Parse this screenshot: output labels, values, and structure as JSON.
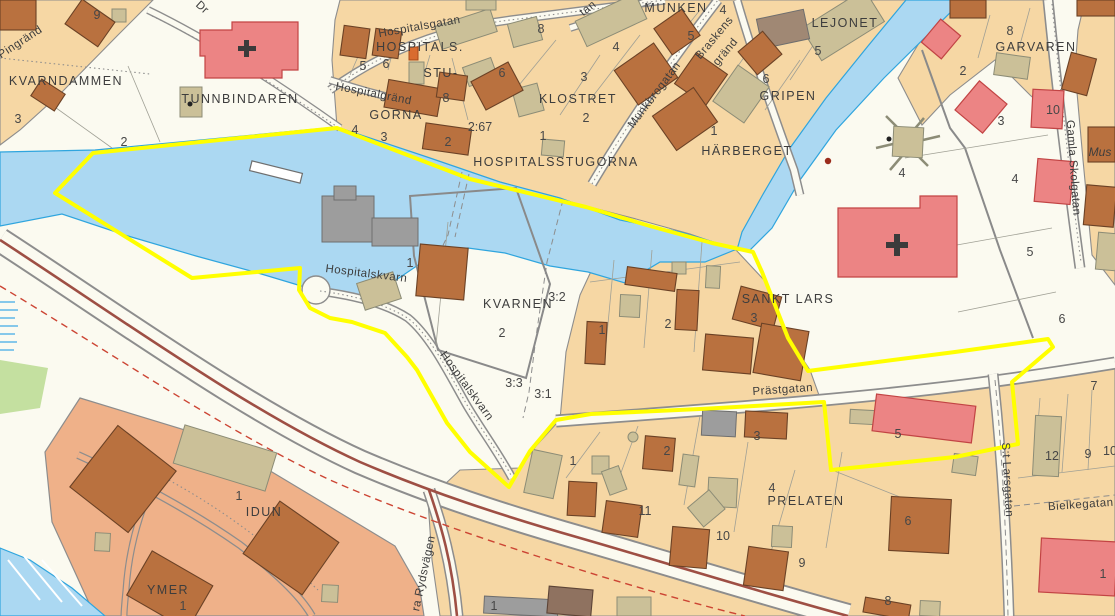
{
  "map": {
    "type": "cadastral-city-map",
    "colors": {
      "bg": "#FBFAF0",
      "block_tan": "#F6D7A4",
      "block_salmon": "#EFB189",
      "water": "#ABD8F2",
      "water_edge": "#2FA5DE",
      "green": "#C4E0A0",
      "building_brown": "#B9713F",
      "building_red": "#EC8484",
      "building_khaki": "#CBC098",
      "building_gray": "#9D9D9D",
      "boundary_yellow": "#FFFF00",
      "main_road": "#9E4F44",
      "dashed_red": "#CC4433",
      "road_edge": "#8D8D8D",
      "label": "#3D3D3D"
    },
    "labels": [
      {
        "t": "KVARNDAMMEN",
        "x": 66,
        "y": 85,
        "r": 0,
        "c": "d"
      },
      {
        "t": "TUNNBINDAREN",
        "x": 240,
        "y": 103,
        "r": 0,
        "c": "d"
      },
      {
        "t": "HOSPITALS.",
        "x": 420,
        "y": 51,
        "r": 0,
        "c": "d"
      },
      {
        "t": "STU-",
        "x": 441,
        "y": 77,
        "r": 0,
        "c": "d"
      },
      {
        "t": "GORNA",
        "x": 396,
        "y": 119,
        "r": 0,
        "c": "d"
      },
      {
        "t": "KLOSTRET",
        "x": 578,
        "y": 103,
        "r": 0,
        "c": "d"
      },
      {
        "t": "MUNKEN",
        "x": 676,
        "y": 12,
        "r": 0,
        "c": "d"
      },
      {
        "t": "LEJONET",
        "x": 845,
        "y": 27,
        "r": 0,
        "c": "d"
      },
      {
        "t": "GRIPEN",
        "x": 788,
        "y": 100,
        "r": 0,
        "c": "d"
      },
      {
        "t": "HÄRBERGET",
        "x": 747,
        "y": 155,
        "r": 0,
        "c": "d"
      },
      {
        "t": "HOSPITALSSTUGORNA",
        "x": 556,
        "y": 166,
        "r": 0,
        "c": "d"
      },
      {
        "t": "GARVAREN",
        "x": 1036,
        "y": 51,
        "r": 0,
        "c": "d"
      },
      {
        "t": "SANKT LARS",
        "x": 788,
        "y": 303,
        "r": 0,
        "c": "d"
      },
      {
        "t": "KVARNEN",
        "x": 518,
        "y": 308,
        "r": 0,
        "c": "d"
      },
      {
        "t": "PRELATEN",
        "x": 806,
        "y": 505,
        "r": 0,
        "c": "d"
      },
      {
        "t": "IDUN",
        "x": 264,
        "y": 516,
        "r": 0,
        "c": "d"
      },
      {
        "t": "YMER",
        "x": 168,
        "y": 594,
        "r": 0,
        "c": "d"
      },
      {
        "t": "Pingränd",
        "x": 22,
        "y": 45,
        "r": -33,
        "c": "s"
      },
      {
        "t": "Dr",
        "x": 200,
        "y": 10,
        "r": 42,
        "c": "s"
      },
      {
        "t": "Hospitalsgatan",
        "x": 420,
        "y": 30,
        "r": -10,
        "c": "s"
      },
      {
        "t": "Hospitalgränd",
        "x": 373,
        "y": 97,
        "r": 11,
        "c": "s"
      },
      {
        "t": "tan",
        "x": 590,
        "y": 11,
        "r": -38,
        "c": "s"
      },
      {
        "t": "Munkbrogatan",
        "x": 657,
        "y": 97,
        "r": -53,
        "c": "s"
      },
      {
        "t": "Braskens",
        "x": 717,
        "y": 40,
        "r": -50,
        "c": "s"
      },
      {
        "t": "gränd",
        "x": 728,
        "y": 54,
        "r": -50,
        "c": "s"
      },
      {
        "t": "Gamla Skolgatan",
        "x": 1070,
        "y": 168,
        "r": 86,
        "c": "s"
      },
      {
        "t": "Mus",
        "x": 1100,
        "y": 156,
        "r": 0,
        "c": "i"
      },
      {
        "t": "Hospitalskvarn",
        "x": 366,
        "y": 277,
        "r": 7,
        "c": "s"
      },
      {
        "t": "Hospitalskvarn",
        "x": 464,
        "y": 388,
        "r": 54,
        "c": "s"
      },
      {
        "t": "Prästgatan",
        "x": 783,
        "y": 393,
        "r": -4,
        "c": "s"
      },
      {
        "t": "S:t Larsgatan",
        "x": 1004,
        "y": 480,
        "r": 87,
        "c": "s"
      },
      {
        "t": "Bielkegatan",
        "x": 1081,
        "y": 508,
        "r": -4,
        "c": "s"
      },
      {
        "t": "ra Rydsvägen",
        "x": 427,
        "y": 574,
        "r": -78,
        "c": "s"
      },
      {
        "t": "9",
        "x": 97,
        "y": 19,
        "r": 0,
        "c": "n"
      },
      {
        "t": "3",
        "x": 18,
        "y": 123,
        "r": 0,
        "c": "n"
      },
      {
        "t": "2",
        "x": 124,
        "y": 146,
        "r": 0,
        "c": "n"
      },
      {
        "t": "5",
        "x": 363,
        "y": 70,
        "r": 0,
        "c": "n"
      },
      {
        "t": "6",
        "x": 386,
        "y": 68,
        "r": 0,
        "c": "n"
      },
      {
        "t": "8",
        "x": 446,
        "y": 102,
        "r": 0,
        "c": "n"
      },
      {
        "t": "6",
        "x": 502,
        "y": 77,
        "r": 0,
        "c": "n"
      },
      {
        "t": "8",
        "x": 541,
        "y": 33,
        "r": 0,
        "c": "n"
      },
      {
        "t": "4",
        "x": 616,
        "y": 51,
        "r": 0,
        "c": "n"
      },
      {
        "t": "3",
        "x": 584,
        "y": 81,
        "r": 0,
        "c": "n"
      },
      {
        "t": "2",
        "x": 586,
        "y": 122,
        "r": 0,
        "c": "n"
      },
      {
        "t": "1",
        "x": 543,
        "y": 140,
        "r": 0,
        "c": "n"
      },
      {
        "t": "4",
        "x": 355,
        "y": 134,
        "r": 0,
        "c": "n"
      },
      {
        "t": "3",
        "x": 384,
        "y": 141,
        "r": 0,
        "c": "n"
      },
      {
        "t": "2:67",
        "x": 480,
        "y": 131,
        "r": 0,
        "c": "n"
      },
      {
        "t": "2",
        "x": 448,
        "y": 146,
        "r": 0,
        "c": "n"
      },
      {
        "t": "4",
        "x": 723,
        "y": 14,
        "r": 0,
        "c": "n"
      },
      {
        "t": "5",
        "x": 691,
        "y": 40,
        "r": 0,
        "c": "n"
      },
      {
        "t": "5",
        "x": 818,
        "y": 55,
        "r": 0,
        "c": "n"
      },
      {
        "t": "6",
        "x": 766,
        "y": 83,
        "r": 0,
        "c": "n"
      },
      {
        "t": "1",
        "x": 714,
        "y": 135,
        "r": 0,
        "c": "n"
      },
      {
        "t": "8",
        "x": 1010,
        "y": 35,
        "r": 0,
        "c": "n"
      },
      {
        "t": "2",
        "x": 963,
        "y": 75,
        "r": 0,
        "c": "n"
      },
      {
        "t": "3",
        "x": 1001,
        "y": 125,
        "r": 0,
        "c": "n"
      },
      {
        "t": "10",
        "x": 1053,
        "y": 114,
        "r": 0,
        "c": "n"
      },
      {
        "t": "4",
        "x": 902,
        "y": 177,
        "r": 0,
        "c": "n"
      },
      {
        "t": "4",
        "x": 1015,
        "y": 183,
        "r": 0,
        "c": "n"
      },
      {
        "t": "5",
        "x": 1030,
        "y": 256,
        "r": 0,
        "c": "n"
      },
      {
        "t": "6",
        "x": 1062,
        "y": 323,
        "r": 0,
        "c": "n"
      },
      {
        "t": "1",
        "x": 410,
        "y": 267,
        "r": 0,
        "c": "n"
      },
      {
        "t": "3:2",
        "x": 557,
        "y": 301,
        "r": 0,
        "c": "n"
      },
      {
        "t": "2",
        "x": 502,
        "y": 337,
        "r": 0,
        "c": "n"
      },
      {
        "t": "3:3",
        "x": 514,
        "y": 387,
        "r": 0,
        "c": "n"
      },
      {
        "t": "3:1",
        "x": 543,
        "y": 398,
        "r": 0,
        "c": "n"
      },
      {
        "t": "1",
        "x": 602,
        "y": 334,
        "r": 0,
        "c": "n"
      },
      {
        "t": "2",
        "x": 668,
        "y": 328,
        "r": 0,
        "c": "n"
      },
      {
        "t": "3",
        "x": 754,
        "y": 322,
        "r": 0,
        "c": "n"
      },
      {
        "t": "4",
        "x": 772,
        "y": 492,
        "r": 0,
        "c": "n"
      },
      {
        "t": "2",
        "x": 667,
        "y": 455,
        "r": 0,
        "c": "n"
      },
      {
        "t": "3",
        "x": 757,
        "y": 440,
        "r": 0,
        "c": "n"
      },
      {
        "t": "5",
        "x": 898,
        "y": 438,
        "r": 0,
        "c": "n"
      },
      {
        "t": "1",
        "x": 573,
        "y": 465,
        "r": 0,
        "c": "n"
      },
      {
        "t": "11",
        "x": 645,
        "y": 515,
        "r": 0,
        "c": "n"
      },
      {
        "t": "10",
        "x": 723,
        "y": 540,
        "r": 0,
        "c": "n"
      },
      {
        "t": "9",
        "x": 802,
        "y": 567,
        "r": 0,
        "c": "n"
      },
      {
        "t": "6",
        "x": 908,
        "y": 525,
        "r": 0,
        "c": "n"
      },
      {
        "t": "8",
        "x": 888,
        "y": 605,
        "r": 0,
        "c": "n"
      },
      {
        "t": "12",
        "x": 1052,
        "y": 460,
        "r": 0,
        "c": "n"
      },
      {
        "t": "9",
        "x": 1088,
        "y": 458,
        "r": 0,
        "c": "n"
      },
      {
        "t": "10",
        "x": 1110,
        "y": 455,
        "r": 0,
        "c": "n"
      },
      {
        "t": "7",
        "x": 1094,
        "y": 390,
        "r": 0,
        "c": "n"
      },
      {
        "t": "1",
        "x": 1103,
        "y": 578,
        "r": 0,
        "c": "n"
      },
      {
        "t": "1",
        "x": 239,
        "y": 500,
        "r": 0,
        "c": "n"
      },
      {
        "t": "1",
        "x": 183,
        "y": 610,
        "r": 0,
        "c": "n"
      },
      {
        "t": "1",
        "x": 494,
        "y": 610,
        "r": 0,
        "c": "n"
      }
    ]
  }
}
